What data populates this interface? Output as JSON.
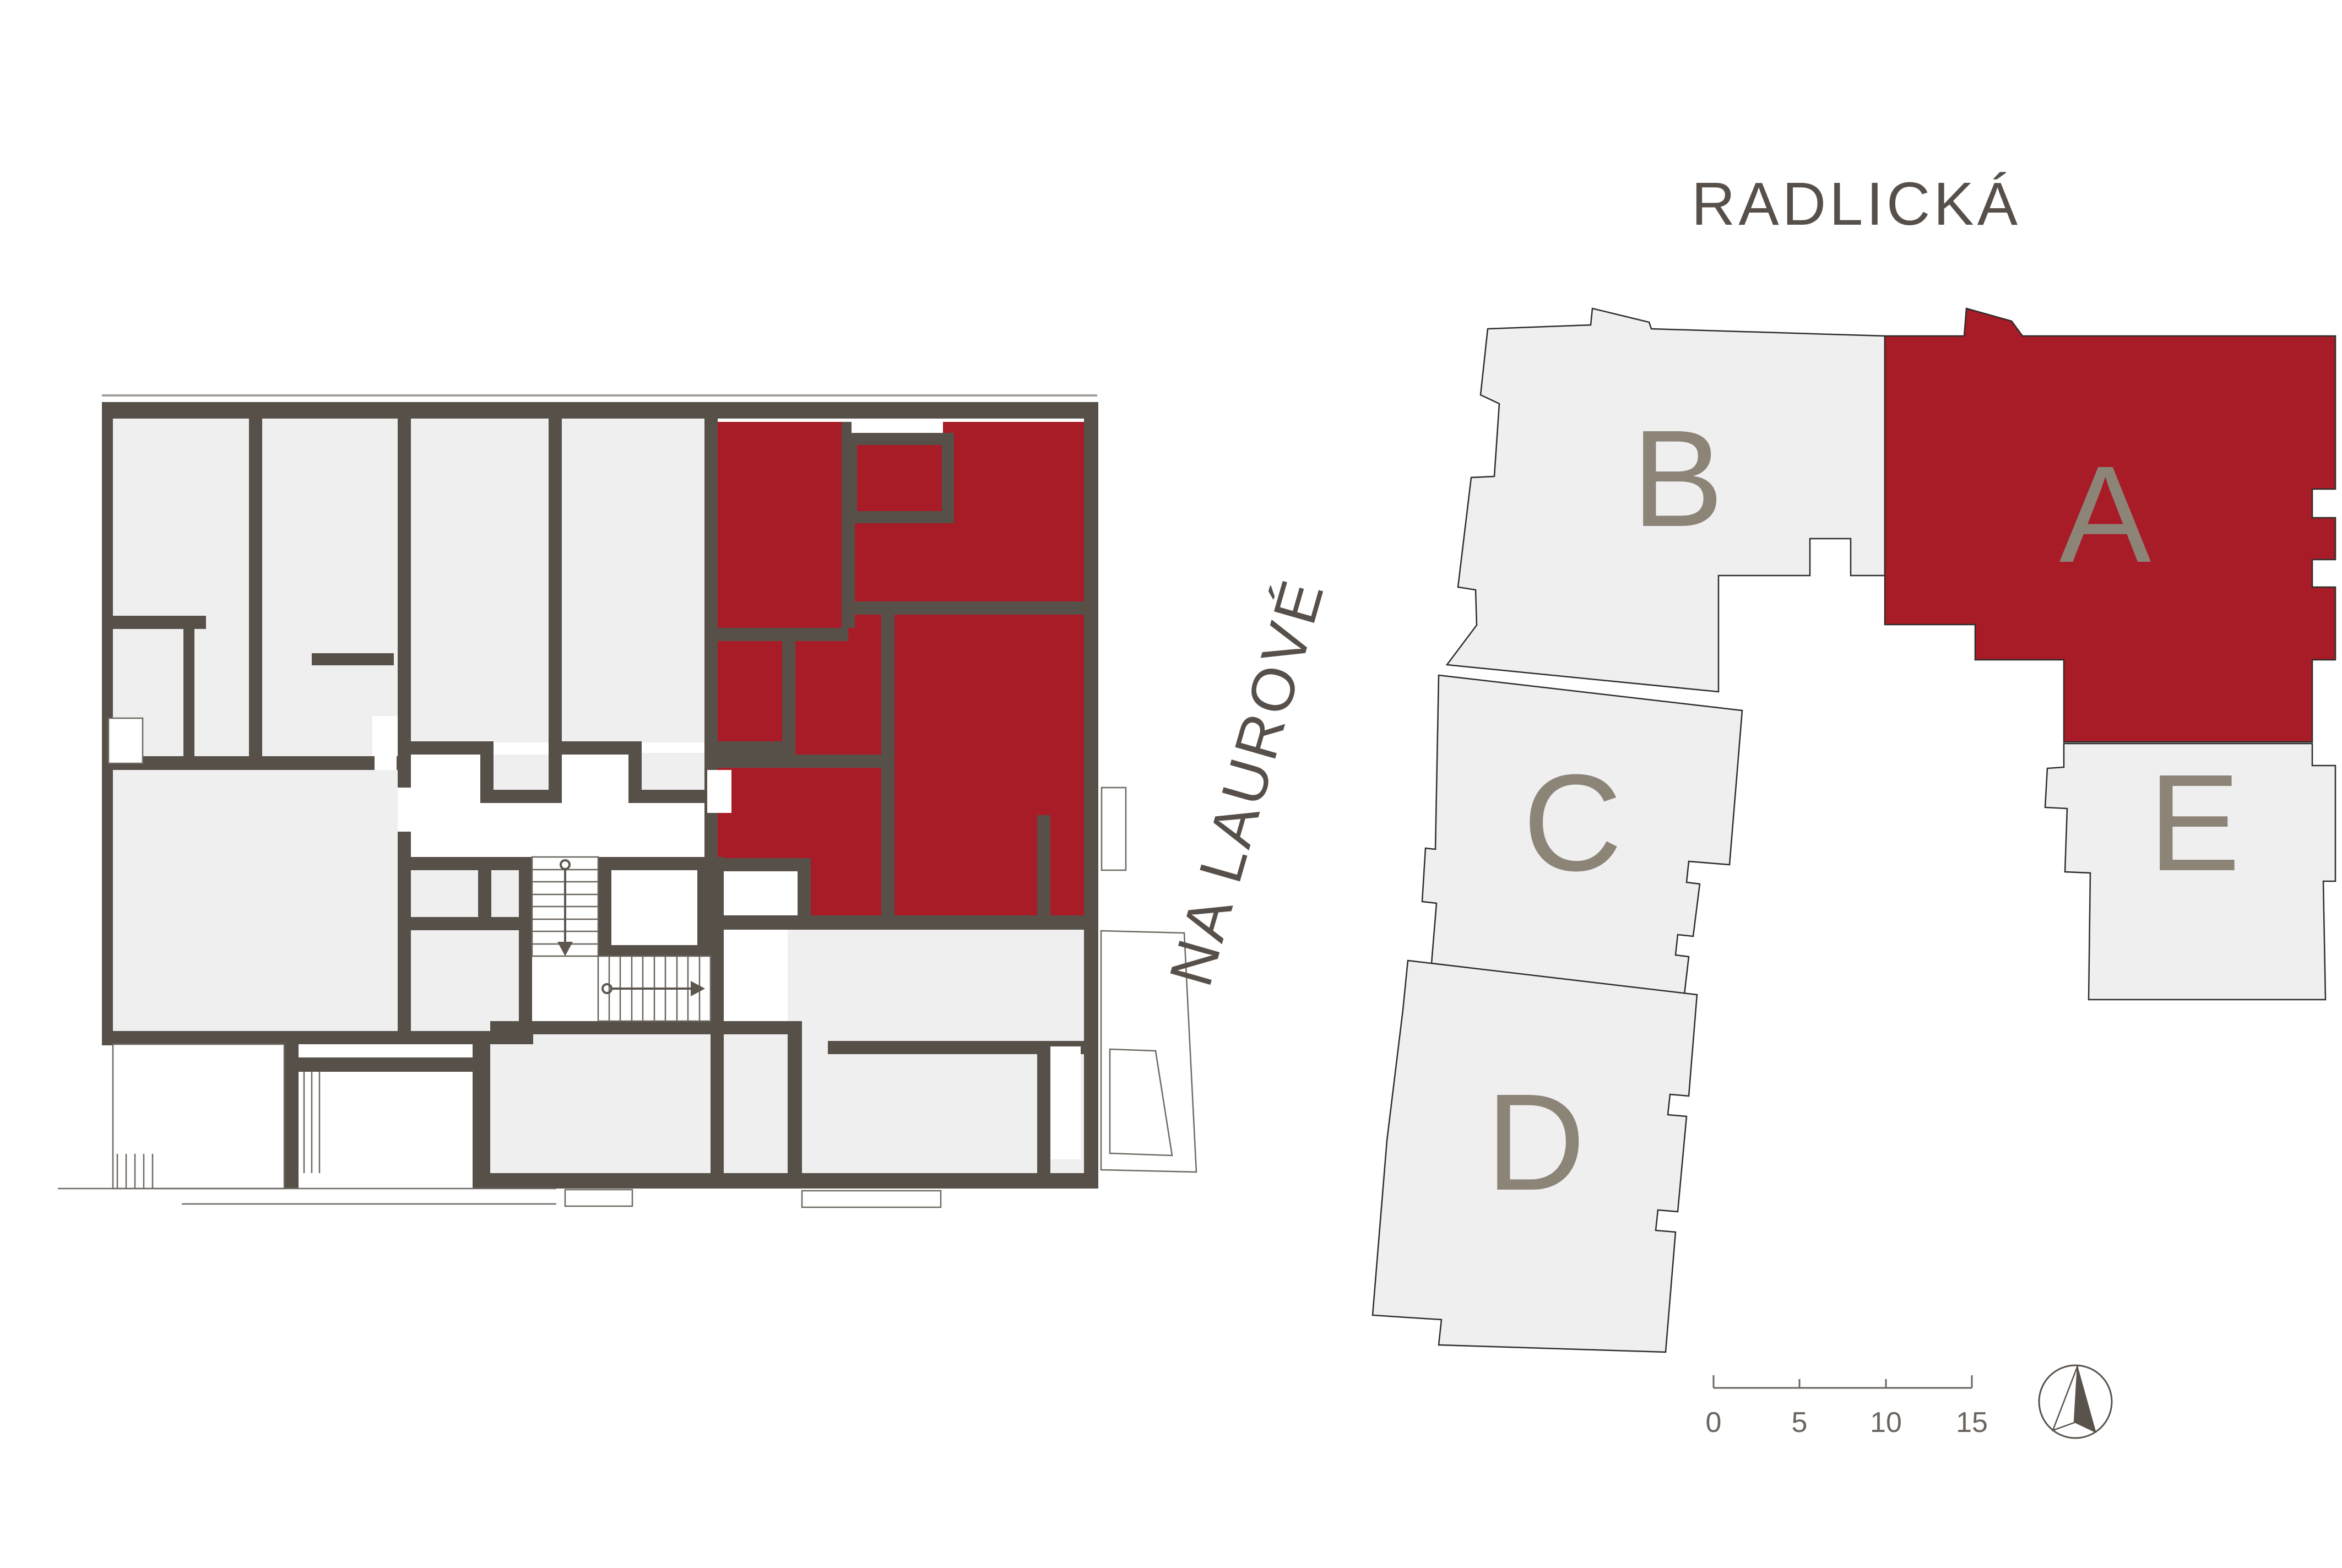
{
  "page": {
    "background": "#ffffff",
    "type": "architectural floor plan and site plan"
  },
  "palette": {
    "wall": "#575049",
    "room_fill": "#efefef",
    "highlight": "#a81c27",
    "building_letter": "#8d8478",
    "street_text": "#57504a",
    "thin_line": "#6f6961",
    "outline": "#2f2d2b"
  },
  "floor_plan": {
    "highlighted_unit": "A",
    "features": {
      "elevator": true,
      "stair_flights": 2,
      "terraces": true,
      "balconies": true
    }
  },
  "site_plan": {
    "streets": [
      {
        "id": "radlicka",
        "label": "RADLICKÁ"
      },
      {
        "id": "na_laurove",
        "label": "NA LAUROVÉ"
      }
    ],
    "buildings": [
      {
        "id": "A",
        "label": "A",
        "highlighted": true
      },
      {
        "id": "B",
        "label": "B",
        "highlighted": false
      },
      {
        "id": "C",
        "label": "C",
        "highlighted": false
      },
      {
        "id": "D",
        "label": "D",
        "highlighted": false
      },
      {
        "id": "E",
        "label": "E",
        "highlighted": false
      }
    ],
    "scale_bar": {
      "tick_labels": [
        "0",
        "5",
        "10",
        "15"
      ]
    },
    "north_arrow": true
  }
}
